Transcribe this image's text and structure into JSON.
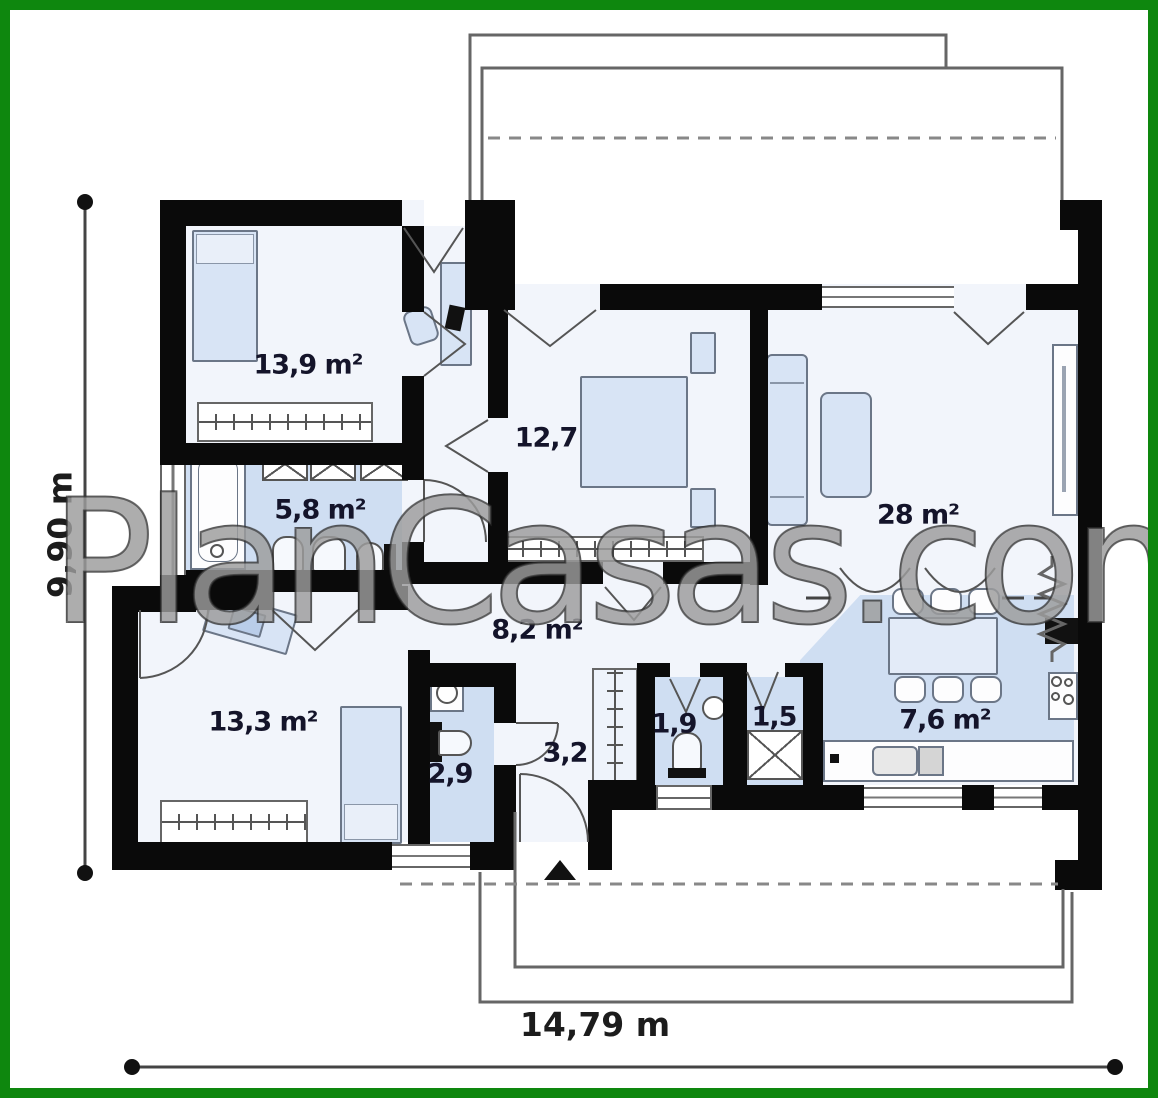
{
  "plan": {
    "watermark": "PlanCasas.com",
    "dimensions": {
      "height_label": "9,90 m",
      "width_label": "14,79 m"
    },
    "rooms": [
      {
        "id": "bedroom-1",
        "label": "13,9 m²"
      },
      {
        "id": "bedroom-2",
        "label": "12,7"
      },
      {
        "id": "bathroom",
        "label": "5,8 m²"
      },
      {
        "id": "living-room",
        "label": "28 m²"
      },
      {
        "id": "hallway",
        "label": "8,2 m²"
      },
      {
        "id": "bedroom-3",
        "label": "13,3 m²"
      },
      {
        "id": "wc-small",
        "label": "2,9"
      },
      {
        "id": "entry-hall",
        "label": "3,2"
      },
      {
        "id": "wc",
        "label": "1,9"
      },
      {
        "id": "utility",
        "label": "1,5"
      },
      {
        "id": "kitchen",
        "label": "7,6 m²"
      }
    ],
    "colors": {
      "frame_green": "#0e870e",
      "wall_black": "#0a0a0a",
      "floor_light": "#f2f5fb",
      "floor_blue": "#cfdef2",
      "furniture_blue": "#d8e4f5",
      "label_color": "#14142a"
    }
  }
}
